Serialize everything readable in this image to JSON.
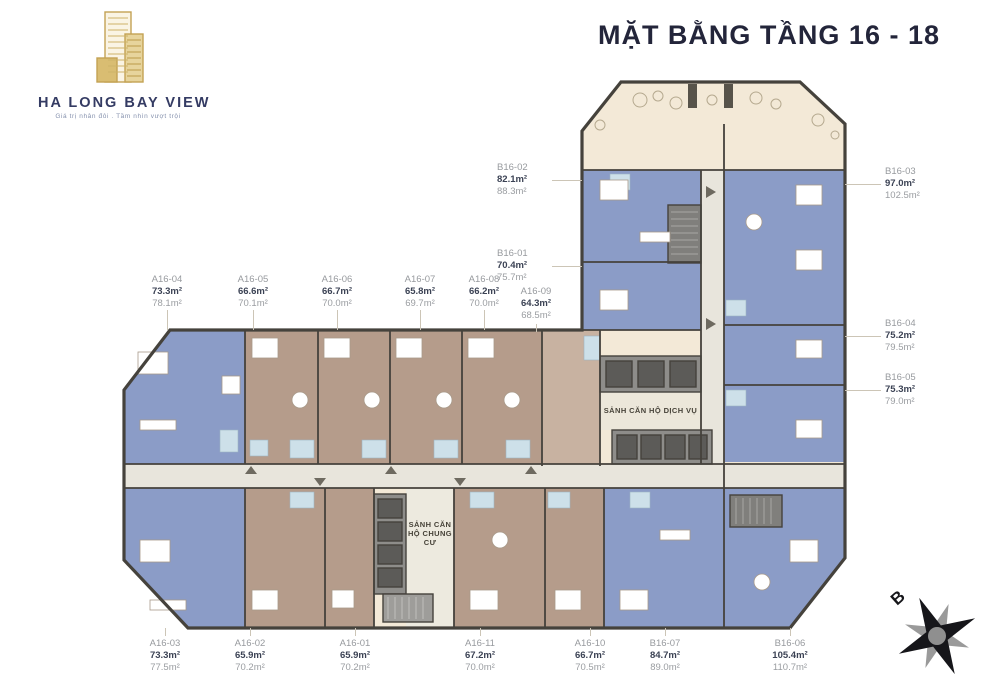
{
  "title": "MẶT BẰNG TẦNG 16 - 18",
  "logo": {
    "name": "HA LONG BAY VIEW",
    "tagline": "Giá trị nhân đôi . Tầm nhìn vượt trội"
  },
  "lobbies": {
    "service": "SẢNH CĂN HỘ DỊCH VỤ",
    "residential": "SẢNH CĂN HỘ CHUNG CƯ"
  },
  "compass": {
    "north_label": "B"
  },
  "colors": {
    "title_navy": "#23253a",
    "logo_gold": "#c2a356",
    "unit_blue": "#8b9cc7",
    "unit_tan": "#b59c8b",
    "cream": "#f3e9d7",
    "wall": "#45423c"
  },
  "units": [
    {
      "id": "A16-04",
      "area1": "73.3m²",
      "area2": "78.1m²",
      "lx": 167,
      "ly": 274,
      "align": "center",
      "leader": [
        167,
        310,
        167,
        330
      ]
    },
    {
      "id": "A16-05",
      "area1": "66.6m²",
      "area2": "70.1m²",
      "lx": 253,
      "ly": 274,
      "align": "center",
      "leader": [
        253,
        310,
        253,
        330
      ]
    },
    {
      "id": "A16-06",
      "area1": "66.7m²",
      "area2": "70.0m²",
      "lx": 337,
      "ly": 274,
      "align": "center",
      "leader": [
        337,
        310,
        337,
        330
      ]
    },
    {
      "id": "A16-07",
      "area1": "65.8m²",
      "area2": "69.7m²",
      "lx": 420,
      "ly": 274,
      "align": "center",
      "leader": [
        420,
        310,
        420,
        330
      ]
    },
    {
      "id": "A16-08",
      "area1": "66.2m²",
      "area2": "70.0m²",
      "lx": 484,
      "ly": 274,
      "align": "center",
      "leader": [
        484,
        310,
        484,
        330
      ]
    },
    {
      "id": "A16-09",
      "area1": "64.3m²",
      "area2": "68.5m²",
      "lx": 536,
      "ly": 286,
      "align": "center",
      "leader": [
        536,
        324,
        536,
        332
      ]
    },
    {
      "id": "B16-01",
      "area1": "70.4m²",
      "area2": "75.7m²",
      "lx": 497,
      "ly": 248,
      "align": "left",
      "leader": [
        552,
        266,
        582,
        266
      ]
    },
    {
      "id": "B16-02",
      "area1": "82.1m²",
      "area2": "88.3m²",
      "lx": 497,
      "ly": 162,
      "align": "left",
      "leader": [
        552,
        180,
        582,
        180
      ]
    },
    {
      "id": "B16-03",
      "area1": "97.0m²",
      "area2": "102.5m²",
      "lx": 885,
      "ly": 166,
      "align": "left",
      "leader": [
        845,
        184,
        881,
        184
      ]
    },
    {
      "id": "B16-04",
      "area1": "75.2m²",
      "area2": "79.5m²",
      "lx": 885,
      "ly": 318,
      "align": "left",
      "leader": [
        845,
        336,
        881,
        336
      ]
    },
    {
      "id": "B16-05",
      "area1": "75.3m²",
      "area2": "79.0m²",
      "lx": 885,
      "ly": 372,
      "align": "left",
      "leader": [
        845,
        390,
        881,
        390
      ]
    },
    {
      "id": "A16-03",
      "area1": "73.3m²",
      "area2": "77.5m²",
      "lx": 165,
      "ly": 638,
      "align": "center",
      "leader": [
        165,
        628,
        165,
        636
      ]
    },
    {
      "id": "A16-02",
      "area1": "65.9m²",
      "area2": "70.2m²",
      "lx": 250,
      "ly": 638,
      "align": "center",
      "leader": [
        250,
        628,
        250,
        636
      ]
    },
    {
      "id": "A16-01",
      "area1": "65.9m²",
      "area2": "70.2m²",
      "lx": 355,
      "ly": 638,
      "align": "center",
      "leader": [
        355,
        628,
        355,
        636
      ]
    },
    {
      "id": "A16-11",
      "area1": "67.2m²",
      "area2": "70.0m²",
      "lx": 480,
      "ly": 638,
      "align": "center",
      "leader": [
        480,
        628,
        480,
        636
      ]
    },
    {
      "id": "A16-10",
      "area1": "66.7m²",
      "area2": "70.5m²",
      "lx": 590,
      "ly": 638,
      "align": "center",
      "leader": [
        590,
        628,
        590,
        636
      ]
    },
    {
      "id": "B16-07",
      "area1": "84.7m²",
      "area2": "89.0m²",
      "lx": 665,
      "ly": 638,
      "align": "center",
      "leader": [
        665,
        628,
        665,
        636
      ]
    },
    {
      "id": "B16-06",
      "area1": "105.4m²",
      "area2": "110.7m²",
      "lx": 790,
      "ly": 638,
      "align": "center",
      "leader": [
        790,
        628,
        790,
        636
      ]
    }
  ]
}
